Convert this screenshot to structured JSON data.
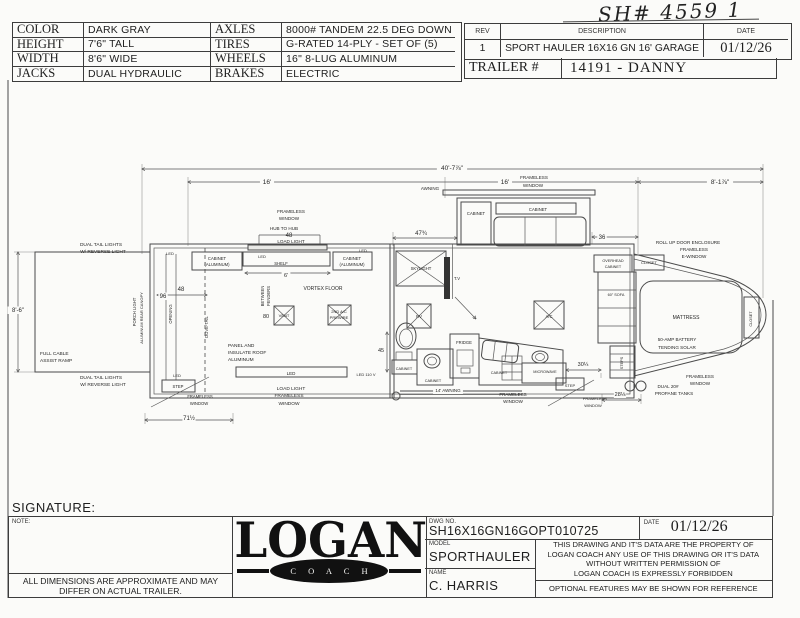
{
  "handwritten_note": "SH# 4559 1",
  "spec_table": {
    "rows": [
      {
        "label": "COLOR",
        "value": "DARK GRAY",
        "label2": "AXLES",
        "value2": "8000# TANDEM 22.5 DEG DOWN"
      },
      {
        "label": "HEIGHT",
        "value": "7'6\" TALL",
        "label2": "TIRES",
        "value2": "G-RATED 14-PLY - SET OF (5)"
      },
      {
        "label": "WIDTH",
        "value": "8'6\" WIDE",
        "label2": "WHEELS",
        "value2": "16\" 8-LUG ALUMINUM"
      },
      {
        "label": "JACKS",
        "value": "DUAL HYDRAULIC",
        "label2": "BRAKES",
        "value2": "ELECTRIC"
      }
    ]
  },
  "rev_table": {
    "headers": [
      "REV",
      "DESCRIPTION",
      "DATE"
    ],
    "rev": "1",
    "description": "SPORT HAULER 16X16 GN 16' GARAGE",
    "date": "01/12/26",
    "trailer_label": "TRAILER #",
    "trailer_value": "14191 - DANNY"
  },
  "signature_label": "SIGNATURE:",
  "title_block": {
    "note_label": "NOTE:",
    "disclaimer_line1": "ALL DIMENSIONS ARE APPROXIMATE AND MAY",
    "disclaimer_line2": "DIFFER ON ACTUAL TRAILER.",
    "logo_text": "LOGAN",
    "logo_sub": "C O A C H",
    "dwg_no_label": "DWG  NO.",
    "dwg_no": "SH16X16GN16GOPT010725",
    "date_label": "DATE",
    "date": "01/12/26",
    "model_label": "MODEL",
    "model": "SPORTHAULER",
    "name_label": "NAME",
    "name": "C. HARRIS",
    "legal_lines": [
      "THIS DRAWING AND IT'S DATA ARE THE PROPERTY OF",
      "LOGAN COACH ANY USE OF THIS DRAWING OR IT'S DATA",
      "WITHOUT WRITTEN PERMISSION OF",
      "LOGAN COACH IS EXPRESSLY FORBIDDEN"
    ],
    "optional_note": "OPTIONAL FEATURES MAY BE SHOWN FOR REFERENCE"
  },
  "floorplan": {
    "labels": [
      {
        "t": "40'-7⅞\"",
        "x": 452,
        "y": 170,
        "s": 6.5,
        "bg": 1
      },
      {
        "t": "16'",
        "x": 267,
        "y": 184,
        "s": 6.5,
        "bg": 1
      },
      {
        "t": "16'",
        "x": 505,
        "y": 184,
        "s": 6.5,
        "bg": 1
      },
      {
        "t": "FRAMELESS",
        "x": 534,
        "y": 179,
        "s": 4.6,
        "bg": 1
      },
      {
        "t": "WINDOW",
        "x": 533,
        "y": 187,
        "s": 4.6,
        "bg": 1
      },
      {
        "t": "8'-1⅞\"",
        "x": 720,
        "y": 184,
        "s": 6.5,
        "bg": 1
      },
      {
        "t": "47¾",
        "x": 421,
        "y": 235,
        "s": 6,
        "bg": 1
      },
      {
        "t": "36",
        "x": 602,
        "y": 239,
        "s": 6,
        "bg": 1
      },
      {
        "t": "8'-6\"",
        "x": 18,
        "y": 312,
        "s": 6,
        "bg": 1
      },
      {
        "t": "96",
        "x": 163,
        "y": 298,
        "s": 6,
        "bg": 1
      },
      {
        "t": "48",
        "x": 181,
        "y": 291,
        "s": 6
      },
      {
        "t": "HUB TO HUB",
        "x": 284,
        "y": 230,
        "s": 4.6
      },
      {
        "t": "48",
        "x": 289,
        "y": 237,
        "s": 6
      },
      {
        "t": "LOAD LIGHT",
        "x": 291,
        "y": 243,
        "s": 4.6
      },
      {
        "t": "FRAMELESS",
        "x": 291,
        "y": 213,
        "s": 4.6
      },
      {
        "t": "WINDOW",
        "x": 289,
        "y": 220,
        "s": 4.6
      },
      {
        "t": "6'",
        "x": 286,
        "y": 277,
        "s": 5.5,
        "bg": 1
      },
      {
        "t": "45",
        "x": 381,
        "y": 352,
        "s": 5.5
      },
      {
        "t": "30¼",
        "x": 583,
        "y": 366,
        "s": 5.5,
        "bg": 1
      },
      {
        "t": "28⅛",
        "x": 620,
        "y": 396,
        "s": 5.5,
        "bg": 1
      },
      {
        "t": "71½",
        "x": 189,
        "y": 420,
        "s": 6,
        "bg": 1
      },
      {
        "t": "DUAL TAIL LIGHTS",
        "x": 101,
        "y": 246,
        "s": 4.8
      },
      {
        "t": "W/ REVERSE LIGHT",
        "x": 103,
        "y": 253,
        "s": 4.8
      },
      {
        "t": "DUAL TAIL LIGHTS",
        "x": 101,
        "y": 379,
        "s": 4.8
      },
      {
        "t": "W/ REVERSE LIGHT",
        "x": 103,
        "y": 386,
        "s": 4.8
      },
      {
        "t": "FULL CABLE",
        "x": 40,
        "y": 355,
        "s": 4.8,
        "a": "start"
      },
      {
        "t": "ASSIST RAMP",
        "x": 40,
        "y": 362,
        "s": 4.8,
        "a": "start"
      },
      {
        "t": "PORCH LIGHT",
        "x": 136,
        "y": 312,
        "s": 4.2,
        "r": -90
      },
      {
        "t": "ALUMINUM REAR CANOPY",
        "x": 143,
        "y": 318,
        "s": 4,
        "r": -90
      },
      {
        "t": "OPENING",
        "x": 172,
        "y": 314,
        "s": 4.2,
        "r": -90
      },
      {
        "t": "DOVE-TAIL",
        "x": 208,
        "y": 327,
        "s": 4.2,
        "r": -90
      },
      {
        "t": "LED",
        "x": 170,
        "y": 255,
        "s": 4
      },
      {
        "t": "CABINET",
        "x": 217,
        "y": 260,
        "s": 4.2
      },
      {
        "t": "(ALUMINUM)",
        "x": 217,
        "y": 266,
        "s": 4.2
      },
      {
        "t": "LED",
        "x": 262,
        "y": 258,
        "s": 4
      },
      {
        "t": "SHELF",
        "x": 281,
        "y": 265,
        "s": 4.2
      },
      {
        "t": "CABINET",
        "x": 352,
        "y": 260,
        "s": 4.2
      },
      {
        "t": "(ALUMINUM)",
        "x": 352,
        "y": 266,
        "s": 4.2
      },
      {
        "t": "LED",
        "x": 363,
        "y": 252,
        "s": 4
      },
      {
        "t": "VORTEX FLOOR",
        "x": 323,
        "y": 290,
        "s": 5
      },
      {
        "t": "BETWEEN",
        "x": 264,
        "y": 296,
        "s": 4.2,
        "r": -90
      },
      {
        "t": "FENDERS",
        "x": 270,
        "y": 296,
        "s": 4.2,
        "r": -90
      },
      {
        "t": "80",
        "x": 266,
        "y": 318,
        "s": 5.5
      },
      {
        "t": "VENT",
        "x": 284,
        "y": 317,
        "s": 4
      },
      {
        "t": "2ND A/C",
        "x": 339,
        "y": 313,
        "s": 4
      },
      {
        "t": "PREWIRE",
        "x": 339,
        "y": 319,
        "s": 4
      },
      {
        "t": "PANEL AND",
        "x": 228,
        "y": 347,
        "s": 4.8,
        "a": "start"
      },
      {
        "t": "INSULATE ROOF",
        "x": 228,
        "y": 354,
        "s": 4.8,
        "a": "start"
      },
      {
        "t": "ALUMINUM",
        "x": 228,
        "y": 361,
        "s": 4.8,
        "a": "start"
      },
      {
        "t": "LED",
        "x": 291,
        "y": 375,
        "s": 4.5
      },
      {
        "t": "LOAD LIGHT",
        "x": 291,
        "y": 390,
        "s": 4.8
      },
      {
        "t": "FRAMELESS",
        "x": 289,
        "y": 397,
        "s": 4.8
      },
      {
        "t": "WINDOW",
        "x": 289,
        "y": 405,
        "s": 4.8
      },
      {
        "t": "LED",
        "x": 177,
        "y": 377,
        "s": 4
      },
      {
        "t": "STEP",
        "x": 178,
        "y": 388,
        "s": 4.2
      },
      {
        "t": "FRAMELESS",
        "x": 200,
        "y": 398,
        "s": 4.2
      },
      {
        "t": "WINDOW",
        "x": 199,
        "y": 405,
        "s": 4.2
      },
      {
        "t": "LED 110 V",
        "x": 366,
        "y": 376,
        "s": 4
      },
      {
        "t": "SKYLIGHT",
        "x": 421,
        "y": 270,
        "s": 4.2
      },
      {
        "t": "T.V",
        "x": 457,
        "y": 280,
        "s": 4.2
      },
      {
        "t": "RV",
        "x": 419,
        "y": 318,
        "s": 4.2
      },
      {
        "t": "CABINET",
        "x": 404,
        "y": 370,
        "s": 3.8
      },
      {
        "t": "CABINET",
        "x": 433,
        "y": 382,
        "s": 3.8
      },
      {
        "t": "FRIDGE",
        "x": 464,
        "y": 344,
        "s": 4.2
      },
      {
        "t": "CABINET",
        "x": 499,
        "y": 374,
        "s": 3.8
      },
      {
        "t": "MICROWAVE",
        "x": 545,
        "y": 373,
        "s": 3.8
      },
      {
        "t": "A/C",
        "x": 549,
        "y": 318,
        "s": 4.2
      },
      {
        "t": "14' AWNING",
        "x": 448,
        "y": 392,
        "s": 4.5,
        "bg": 1
      },
      {
        "t": "FRAMELESS",
        "x": 513,
        "y": 396,
        "s": 4.5
      },
      {
        "t": "WINDOW",
        "x": 513,
        "y": 403,
        "s": 4.5
      },
      {
        "t": "AWNING",
        "x": 430,
        "y": 190,
        "s": 4.5,
        "bg": 1
      },
      {
        "t": "CABINET",
        "x": 476,
        "y": 215,
        "s": 4.2
      },
      {
        "t": "CABINET",
        "x": 538,
        "y": 211,
        "s": 4.2
      },
      {
        "t": "ROLL UP DOOR ENCLOSURE",
        "x": 688,
        "y": 244,
        "s": 4.6
      },
      {
        "t": "FRAMELESS",
        "x": 694,
        "y": 251,
        "s": 4.6
      },
      {
        "t": "E-WINDOW",
        "x": 694,
        "y": 258,
        "s": 4.6
      },
      {
        "t": "OVERHEAD",
        "x": 613,
        "y": 262,
        "s": 3.8
      },
      {
        "t": "CABINET",
        "x": 613,
        "y": 268,
        "s": 3.8
      },
      {
        "t": "CLOSET",
        "x": 649,
        "y": 264,
        "s": 4
      },
      {
        "t": "60\" SOFA",
        "x": 616,
        "y": 296,
        "s": 3.8
      },
      {
        "t": "MATTRESS",
        "x": 686,
        "y": 319,
        "s": 5
      },
      {
        "t": "50-AMP BATTERY",
        "x": 677,
        "y": 341,
        "s": 4.6
      },
      {
        "t": "TENDING SOLAR",
        "x": 677,
        "y": 349,
        "s": 4.6
      },
      {
        "t": "CLOSET",
        "x": 752,
        "y": 319,
        "s": 3.8,
        "r": -90
      },
      {
        "t": "STEPS",
        "x": 623,
        "y": 363,
        "s": 3.8,
        "r": -90
      },
      {
        "t": "STEP",
        "x": 570,
        "y": 387,
        "s": 4
      },
      {
        "t": "FRAMELESS",
        "x": 595,
        "y": 400,
        "s": 4
      },
      {
        "t": "WINDOW",
        "x": 593,
        "y": 407,
        "s": 4
      },
      {
        "t": "FRAMELESS",
        "x": 700,
        "y": 378,
        "s": 4.6
      },
      {
        "t": "WINDOW",
        "x": 700,
        "y": 385,
        "s": 4.6
      },
      {
        "t": "DUAL 20#",
        "x": 668,
        "y": 388,
        "s": 4.6
      },
      {
        "t": "PROPANE TANKS",
        "x": 674,
        "y": 395,
        "s": 4.6
      }
    ]
  }
}
